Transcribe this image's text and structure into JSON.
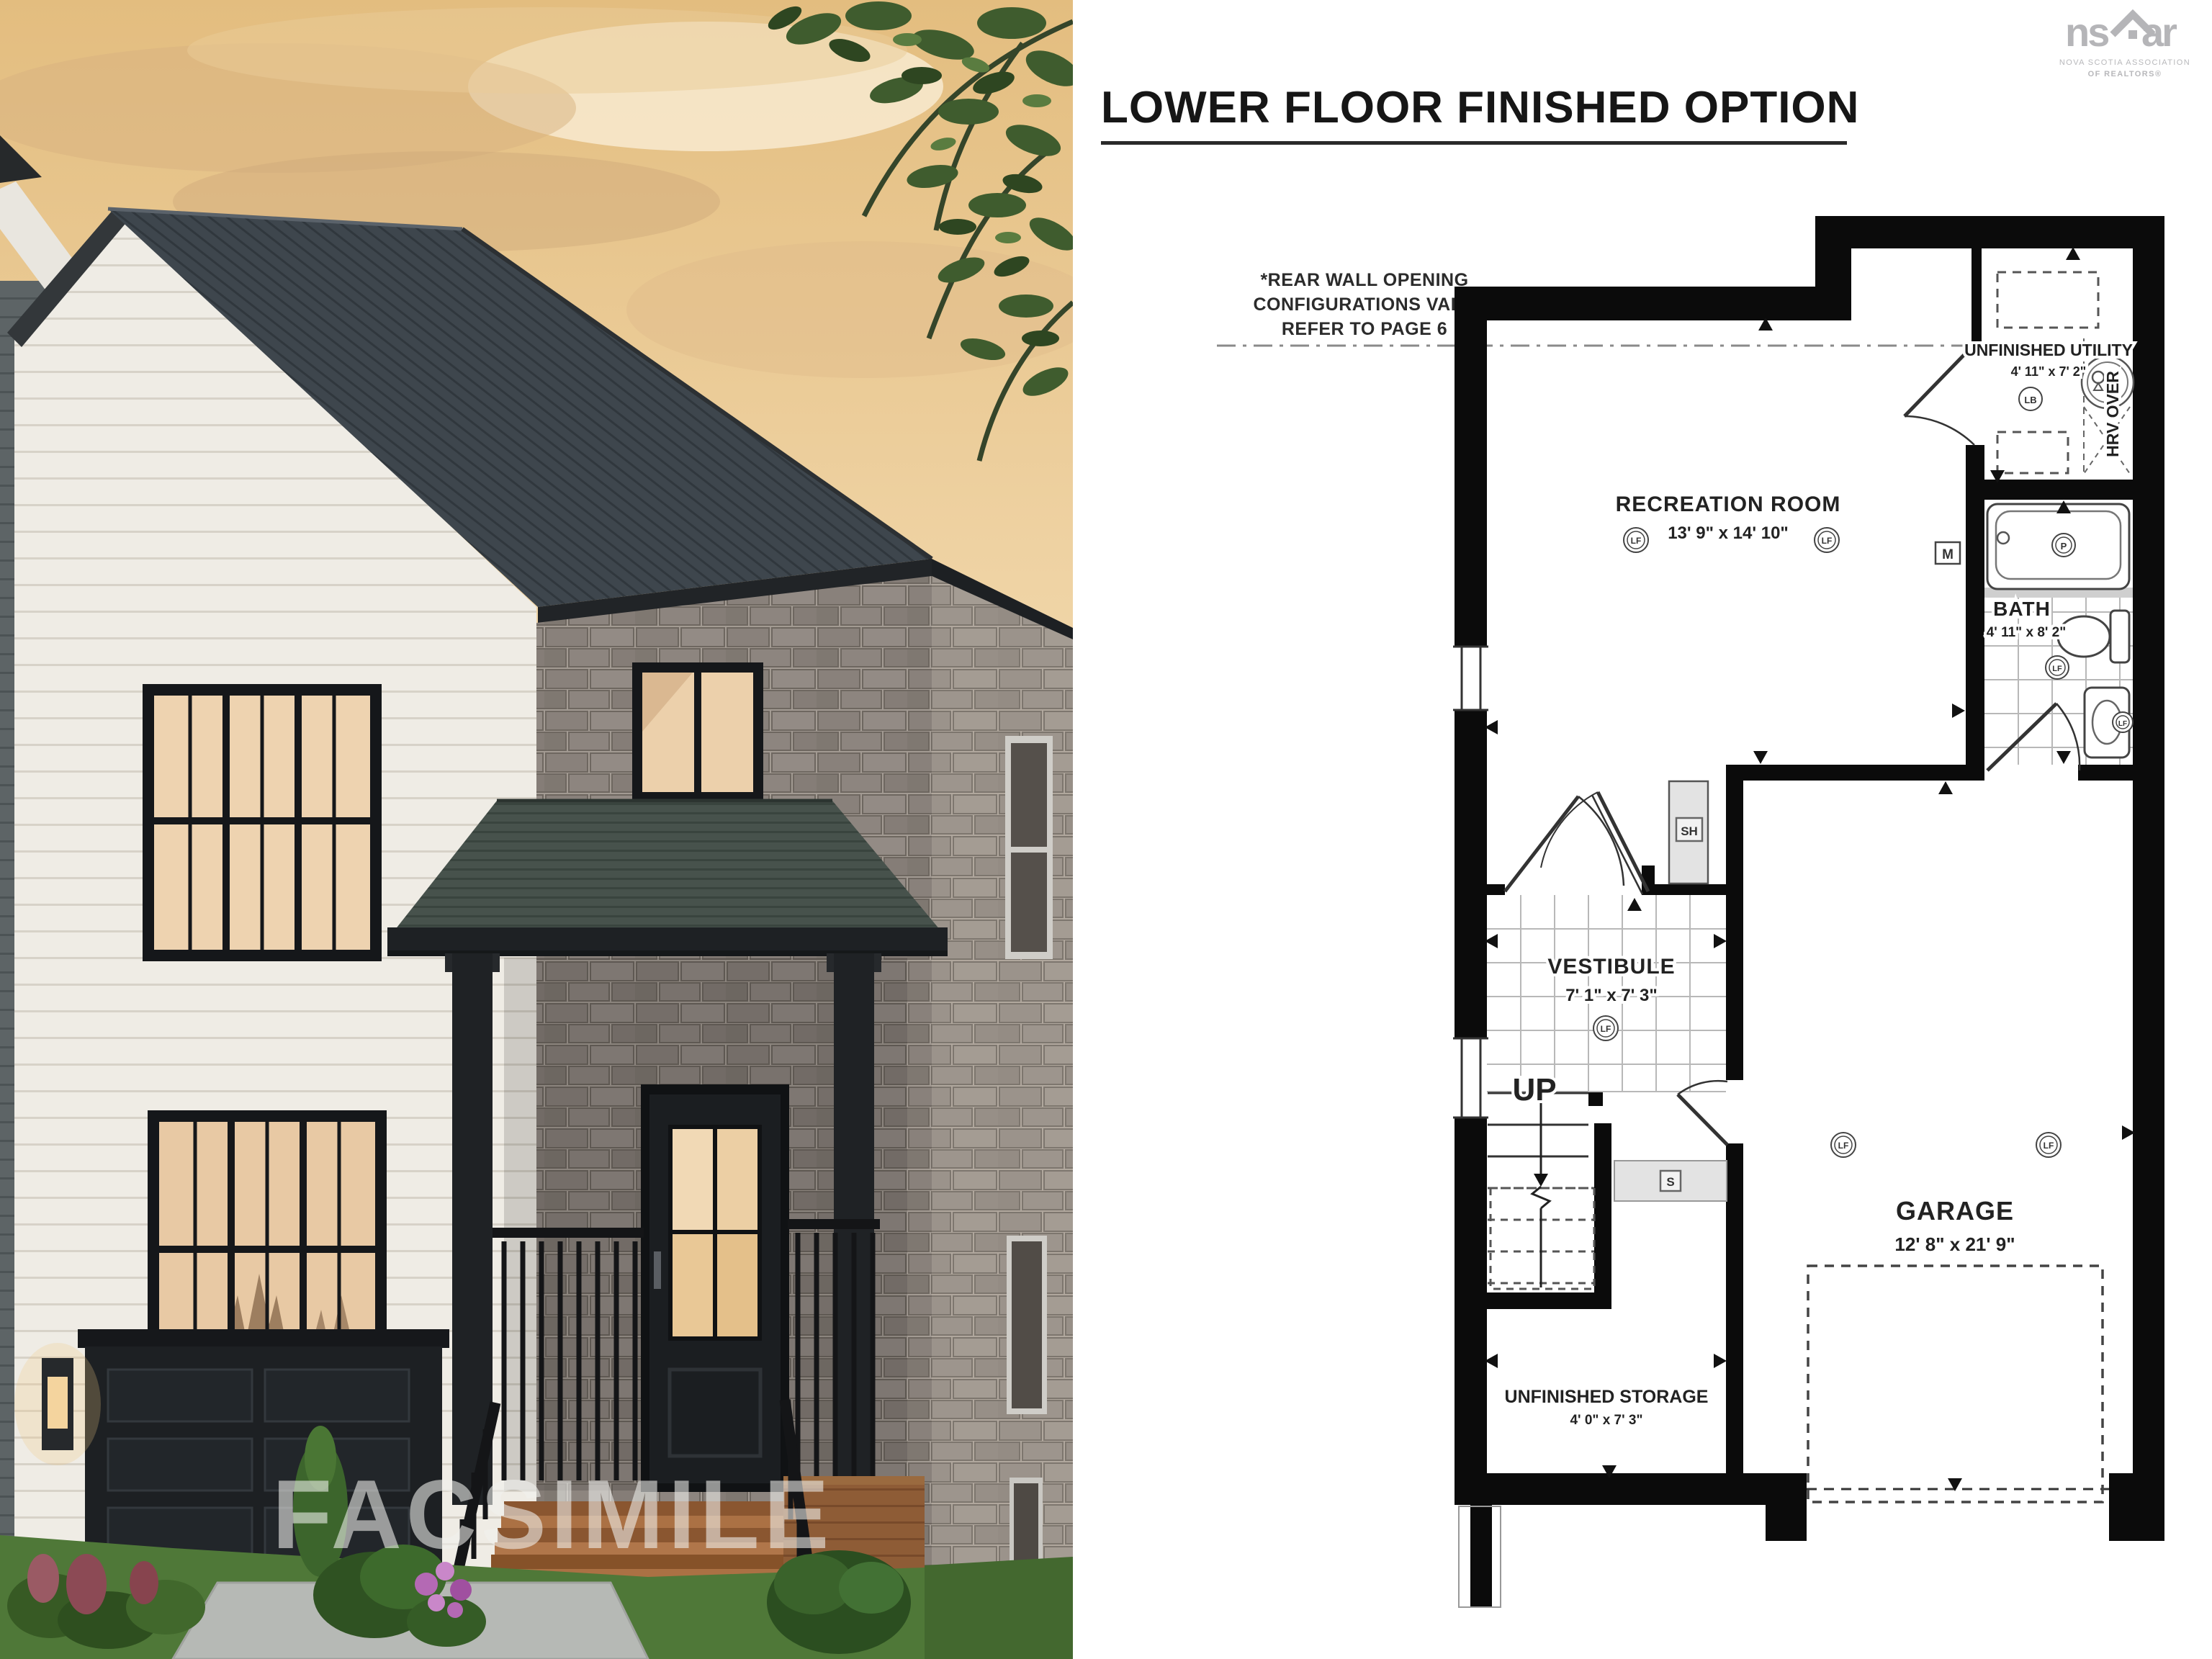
{
  "photo": {
    "watermark": "FACSIMILE"
  },
  "header": {
    "title": "LOWER FLOOR FINISHED OPTION"
  },
  "logo": {
    "ns": "ns",
    "ar": "ar",
    "line1": "NOVA SCOTIA ASSOCIATION",
    "line2": "OF REALTORS®"
  },
  "note": {
    "line1": "*REAR WALL OPENING",
    "line2": "CONFIGURATIONS VARY",
    "line3": "REFER TO PAGE 6"
  },
  "plan": {
    "rooms": {
      "recreation": {
        "name": "RECREATION ROOM",
        "dims": "13' 9\" x 14' 10\""
      },
      "utility": {
        "name": "UNFINISHED UTILITY",
        "dims": "4' 11\" x 7' 2\""
      },
      "bath": {
        "name": "BATH",
        "dims": "4' 11\" x 8' 2\""
      },
      "vestibule": {
        "name": "VESTIBULE",
        "dims": "7' 1\" x 7' 3\""
      },
      "garage": {
        "name": "GARAGE",
        "dims": "12' 8\" x 21' 9\""
      },
      "storage": {
        "name": "UNFINISHED STORAGE",
        "dims": "4' 0\" x 7' 3\""
      }
    },
    "labels": {
      "up": "UP",
      "hrv": "HRV OVER"
    },
    "symbols": {
      "lf": "LF",
      "lb": "LB",
      "p": "P",
      "m": "M",
      "s": "S",
      "sh": "SH"
    }
  },
  "colors": {
    "wall": "#0b0b0b",
    "sky": "#eecf9d",
    "roof": "#3e464d",
    "stone": "#89817b",
    "logo_gray": "#b5b5b8"
  }
}
